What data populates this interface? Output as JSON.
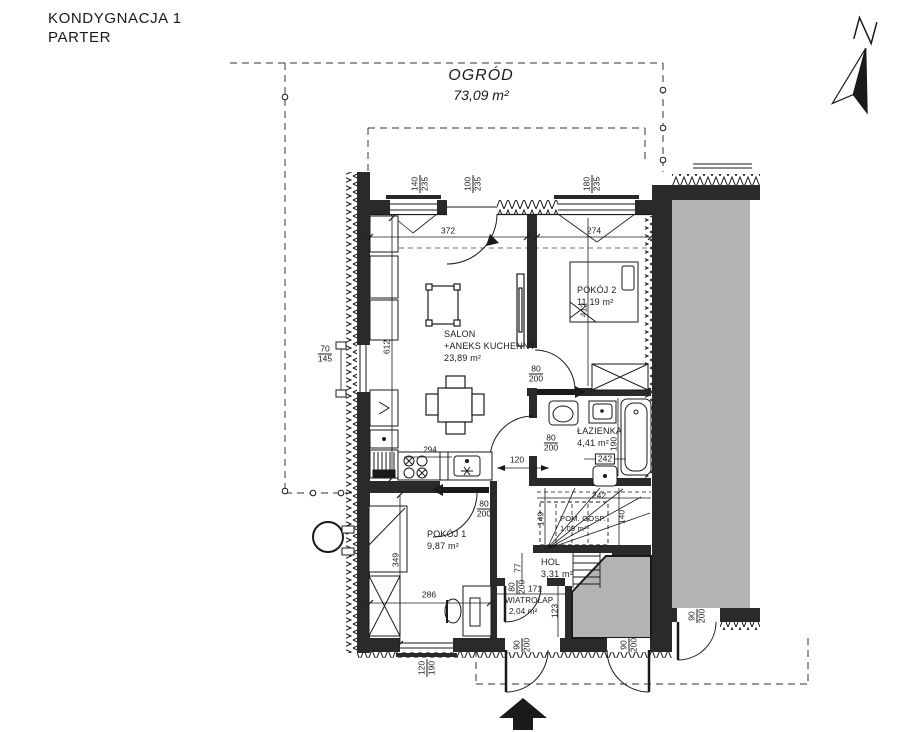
{
  "title": {
    "line1": "KONDYGNACJA 1",
    "line2": "PARTER"
  },
  "garden": {
    "name": "OGRÓD",
    "area": "73,09 m²"
  },
  "rooms": {
    "salon": {
      "name": "SALON",
      "name2": "+ANEKS KUCHENNY",
      "area": "23,89 m²"
    },
    "pokoj2": {
      "name": "POKÓJ 2",
      "area": "11,19 m²"
    },
    "lazienka": {
      "name": "ŁAZIENKA",
      "area": "4,41 m²"
    },
    "pokoj1": {
      "name": "POKÓJ 1",
      "area": "9,87 m²"
    },
    "hol": {
      "name": "HOL",
      "area": "3,31 m²"
    },
    "wiatrolap": {
      "name": "WIATROŁAP",
      "area": "2,04 m²"
    },
    "pom_gosp": {
      "name": "POM. GOSP.",
      "area": "1,09 m²"
    }
  },
  "dims": {
    "salon_width": "372",
    "pokoj2_width": "274",
    "salon_height": "612",
    "bed_length": "412",
    "bath_width_box": "242",
    "bath_height": "190",
    "stairs_width": "242",
    "stairs_height": "140",
    "stairs_left": "149",
    "counter": "294",
    "corridor": "120",
    "hol_height": "77",
    "wiatrolap_width": "171",
    "wiatrolap_height": "123",
    "pokoj1_height": "349",
    "pokoj1_width": "286",
    "win_top_1": {
      "a": "140",
      "b": "235"
    },
    "win_top_2": {
      "a": "100",
      "b": "235"
    },
    "win_top_3": {
      "a": "180",
      "b": "235"
    },
    "win_left": {
      "a": "70",
      "b": "145"
    },
    "win_bottom": {
      "a": "120",
      "b": "190"
    },
    "door_interior": {
      "a": "80",
      "b": "200"
    },
    "door_exterior": {
      "a": "90",
      "b": "200"
    }
  },
  "icons": {
    "north_arrow": "north-arrow",
    "entrance_arrow": "entrance-arrow"
  },
  "colors": {
    "line": "#1a1a1a",
    "wall": "#2a2a2a",
    "neighbor_fill": "#b3b3b3"
  }
}
